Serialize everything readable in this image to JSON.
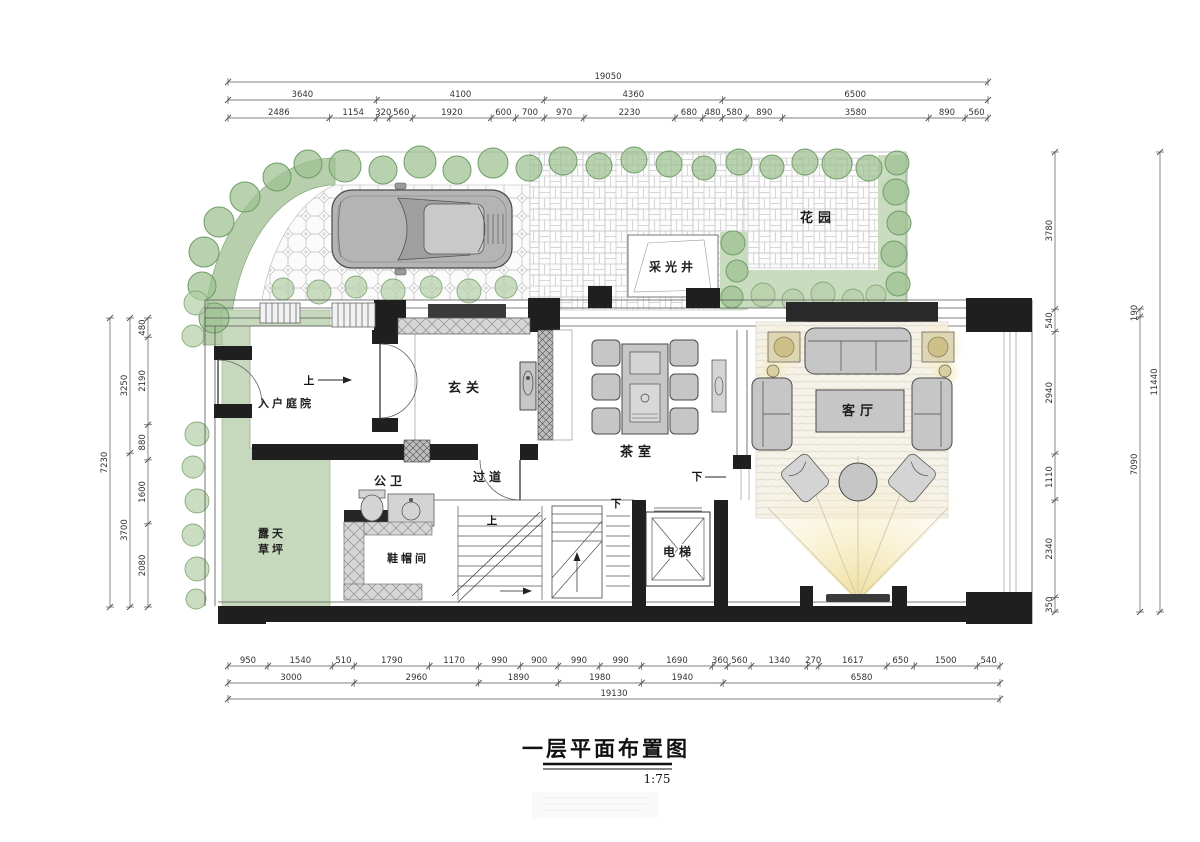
{
  "title": {
    "text": "一层平面布置图",
    "scale": "1:75"
  },
  "rooms": {
    "garden": "花园",
    "light_well": "采光井",
    "entry_courtyard": "入户庭院",
    "foyer": "玄关",
    "tea_room": "茶室",
    "living_room": "客厅",
    "bathroom": "公卫",
    "corridor": "过道",
    "cloakroom": "鞋帽间",
    "elevator": "电梯",
    "lawn_line1": "露天",
    "lawn_line2": "草坪"
  },
  "annotations": {
    "up": "上",
    "down": "下"
  },
  "dims": {
    "top": {
      "overall": [
        19050
      ],
      "groups": [
        3640,
        4100,
        4360,
        6500
      ],
      "detail": [
        2486,
        1154,
        320,
        560,
        1920,
        600,
        700,
        970,
        2230,
        680,
        480,
        580,
        890,
        3580,
        890,
        560
      ]
    },
    "bottom": {
      "detail": [
        950,
        1540,
        510,
        1790,
        1170,
        990,
        900,
        990,
        990,
        1690,
        360,
        560,
        1340,
        270,
        1617,
        650,
        1500,
        540
      ],
      "groups": [
        3000,
        2960,
        1890,
        1980,
        1940,
        6580
      ],
      "overall": [
        19130
      ]
    },
    "left": {
      "outer": [
        7230
      ],
      "mid": [
        3250,
        3700
      ],
      "inner": [
        480,
        2190,
        880,
        1600,
        2080
      ]
    },
    "right": {
      "inner": [
        3780,
        540,
        2940,
        1110,
        2340,
        350
      ],
      "mid": [
        190,
        7090
      ],
      "outer": [
        11440
      ]
    }
  },
  "colors": {
    "wall": "#1f1f1f",
    "tv_wall": "#2a2a2a",
    "tree_green": "#9cc190",
    "lawn_green": "#c6d9bc",
    "hedge_band_green": "#b7cfad",
    "glow_yellow": "#f1df96",
    "furniture_gray": "#c6c6c6",
    "dim_text": "#333333"
  }
}
